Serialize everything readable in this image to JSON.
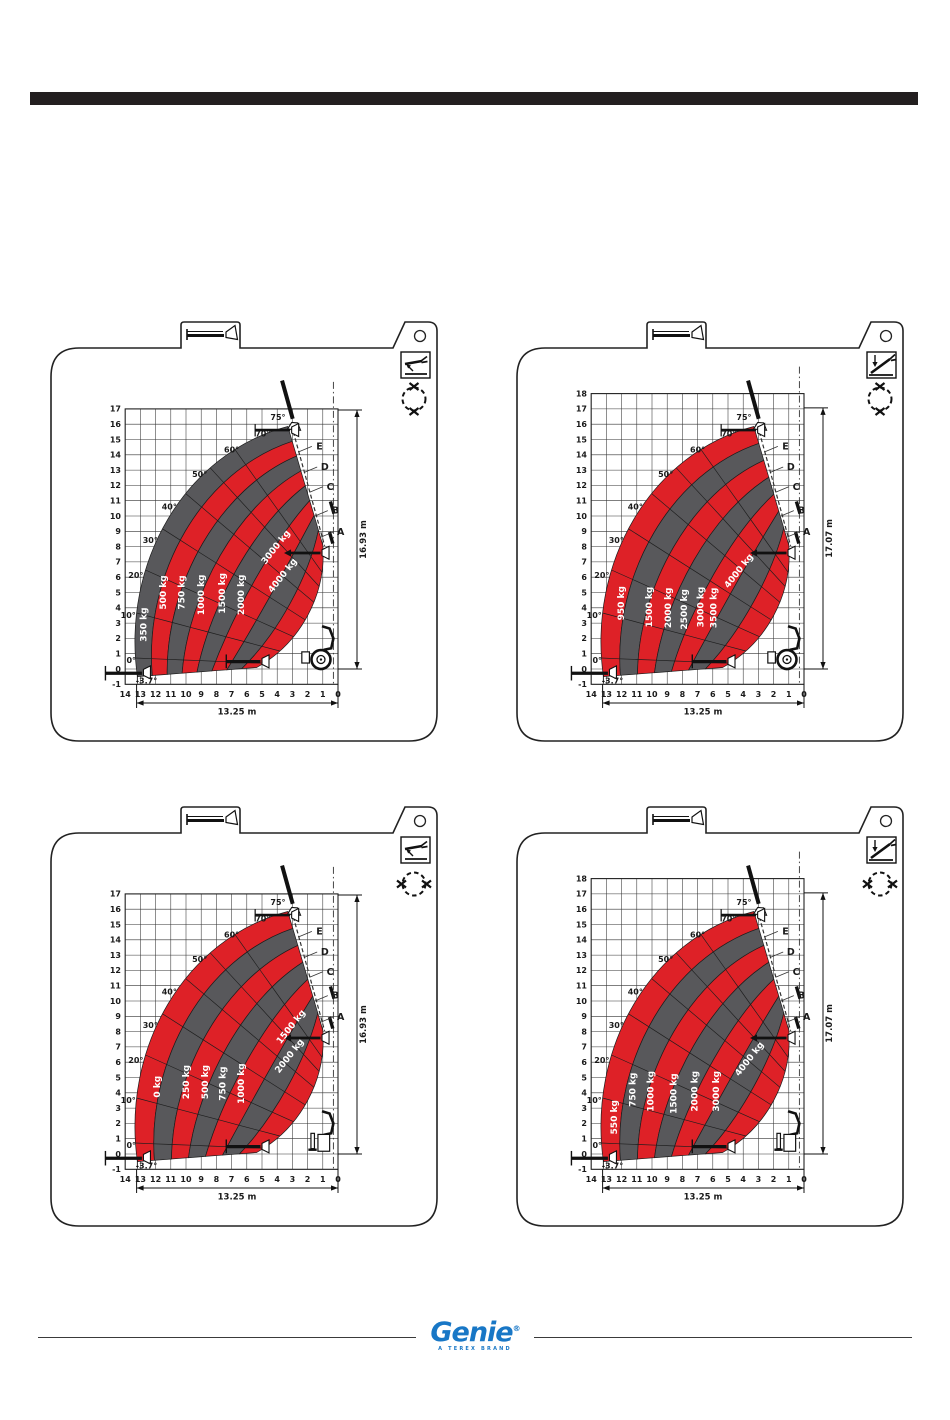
{
  "page": {
    "top_bar_color": "#231f20",
    "background": "#ffffff"
  },
  "colors": {
    "red": "#DE2127",
    "gray": "#58585B",
    "line": "#231f20",
    "white": "#ffffff"
  },
  "footer": {
    "brand": "Genie",
    "registered": "®",
    "tagline": "A TEREX BRAND",
    "brand_color": "#1877c6"
  },
  "charts": [
    {
      "id": "top-left",
      "mode_icon": "machine-level-wrench-icon",
      "swing_icon": "dashed-circle-x-vertical-icon",
      "tab_icon": "boom-fork-icon",
      "chart_data": {
        "type": "area",
        "subtype": "telehandler-load-capacity-chart",
        "x_ticks": [
          "14",
          "13",
          "12",
          "11",
          "10",
          "9",
          "8",
          "7",
          "6",
          "5",
          "4",
          "3",
          "2",
          "1",
          "0"
        ],
        "y_ticks": [
          "17",
          "16",
          "15",
          "14",
          "13",
          "12",
          "11",
          "10",
          "9",
          "8",
          "7",
          "6",
          "5",
          "4",
          "3",
          "2",
          "1",
          "0",
          "-1"
        ],
        "xlim": [
          14,
          0
        ],
        "ylim": [
          -1,
          17
        ],
        "grid": true,
        "zones": [
          {
            "label": "350 kg",
            "color": "gray"
          },
          {
            "label": "500 kg",
            "color": "red"
          },
          {
            "label": "750 kg",
            "color": "gray"
          },
          {
            "label": "1000 kg",
            "color": "red"
          },
          {
            "label": "1500 kg",
            "color": "gray"
          },
          {
            "label": "2000 kg",
            "color": "red"
          },
          {
            "label": "3000 kg",
            "color": "gray"
          },
          {
            "label": "4000 kg",
            "color": "red"
          }
        ],
        "angle_labels": [
          "75°",
          "70°",
          "60°",
          "50°",
          "40°",
          "30°",
          "20°",
          "10°",
          "0°"
        ],
        "min_angle_label": "-3.7°",
        "boom_letters": [
          "A",
          "B",
          "C",
          "D",
          "E"
        ],
        "height_dimension": "16.93 m",
        "width_dimension": "13.25 m"
      }
    },
    {
      "id": "top-right",
      "mode_icon": "machine-tilt-wrench-icon",
      "swing_icon": "dashed-circle-x-vertical-icon",
      "tab_icon": "boom-fork-icon",
      "chart_data": {
        "type": "area",
        "subtype": "telehandler-load-capacity-chart",
        "x_ticks": [
          "14",
          "13",
          "12",
          "11",
          "10",
          "9",
          "8",
          "7",
          "6",
          "5",
          "4",
          "3",
          "2",
          "1",
          "0"
        ],
        "y_ticks": [
          "18",
          "17",
          "16",
          "15",
          "14",
          "13",
          "12",
          "11",
          "10",
          "9",
          "8",
          "7",
          "6",
          "5",
          "4",
          "3",
          "2",
          "1",
          "0",
          "-1"
        ],
        "xlim": [
          14,
          0
        ],
        "ylim": [
          -1,
          18
        ],
        "grid": true,
        "zones": [
          {
            "label": "950 kg",
            "color": "red"
          },
          {
            "label": "1500 kg",
            "color": "gray"
          },
          {
            "label": "2000 kg",
            "color": "red"
          },
          {
            "label": "2500 kg",
            "color": "gray"
          },
          {
            "label": "3000 kg",
            "color": "red"
          },
          {
            "label": "3500 kg",
            "color": "gray"
          },
          {
            "label": "4000 kg",
            "color": "red"
          }
        ],
        "angle_labels": [
          "75°",
          "70°",
          "60°",
          "50°",
          "40°",
          "30°",
          "20°",
          "10°",
          "0°"
        ],
        "min_angle_label": "-3.7°",
        "boom_letters": [
          "A",
          "B",
          "C",
          "D",
          "E"
        ],
        "height_dimension": "17.07 m",
        "width_dimension": "13.25 m"
      }
    },
    {
      "id": "bottom-left",
      "mode_icon": "machine-level-wrench-icon",
      "swing_icon": "dashed-circle-x-horizontal-icon",
      "tab_icon": "boom-fork-icon",
      "chart_data": {
        "type": "area",
        "subtype": "telehandler-load-capacity-chart",
        "x_ticks": [
          "14",
          "13",
          "12",
          "11",
          "10",
          "9",
          "8",
          "7",
          "6",
          "5",
          "4",
          "3",
          "2",
          "1",
          "0"
        ],
        "y_ticks": [
          "17",
          "16",
          "15",
          "14",
          "13",
          "12",
          "11",
          "10",
          "9",
          "8",
          "7",
          "6",
          "5",
          "4",
          "3",
          "2",
          "1",
          "0",
          "-1"
        ],
        "xlim": [
          14,
          0
        ],
        "ylim": [
          -1,
          17
        ],
        "grid": true,
        "zones": [
          {
            "label": "0 kg",
            "color": "red"
          },
          {
            "label": "250 kg",
            "color": "gray"
          },
          {
            "label": "500 kg",
            "color": "red"
          },
          {
            "label": "750 kg",
            "color": "gray"
          },
          {
            "label": "1000 kg",
            "color": "red"
          },
          {
            "label": "1500 kg",
            "color": "gray"
          },
          {
            "label": "2000 kg",
            "color": "red"
          }
        ],
        "angle_labels": [
          "75°",
          "70°",
          "60°",
          "50°",
          "40°",
          "30°",
          "20°",
          "10°",
          "0°"
        ],
        "min_angle_label": "-3.7°",
        "boom_letters": [
          "A",
          "B",
          "C",
          "D",
          "E"
        ],
        "height_dimension": "16.93 m",
        "width_dimension": "13.25 m"
      }
    },
    {
      "id": "bottom-right",
      "mode_icon": "machine-tilt-wrench-icon",
      "swing_icon": "dashed-circle-x-horizontal-icon",
      "tab_icon": "boom-fork-icon",
      "chart_data": {
        "type": "area",
        "subtype": "telehandler-load-capacity-chart",
        "x_ticks": [
          "14",
          "13",
          "12",
          "11",
          "10",
          "9",
          "8",
          "7",
          "6",
          "5",
          "4",
          "3",
          "2",
          "1",
          "0"
        ],
        "y_ticks": [
          "18",
          "17",
          "16",
          "15",
          "14",
          "13",
          "12",
          "11",
          "10",
          "9",
          "8",
          "7",
          "6",
          "5",
          "4",
          "3",
          "2",
          "1",
          "0",
          "-1"
        ],
        "xlim": [
          14,
          0
        ],
        "ylim": [
          -1,
          18
        ],
        "grid": true,
        "zones": [
          {
            "label": "550 kg",
            "color": "red"
          },
          {
            "label": "750 kg",
            "color": "gray"
          },
          {
            "label": "1000 kg",
            "color": "red"
          },
          {
            "label": "1500 kg",
            "color": "gray"
          },
          {
            "label": "2000 kg",
            "color": "red"
          },
          {
            "label": "3000 kg",
            "color": "gray"
          },
          {
            "label": "4000 kg",
            "color": "red"
          }
        ],
        "angle_labels": [
          "75°",
          "70°",
          "60°",
          "50°",
          "40°",
          "30°",
          "20°",
          "10°",
          "0°"
        ],
        "min_angle_label": "-3.7°",
        "boom_letters": [
          "A",
          "B",
          "C",
          "D",
          "E"
        ],
        "height_dimension": "17.07 m",
        "width_dimension": "13.25 m"
      }
    }
  ]
}
